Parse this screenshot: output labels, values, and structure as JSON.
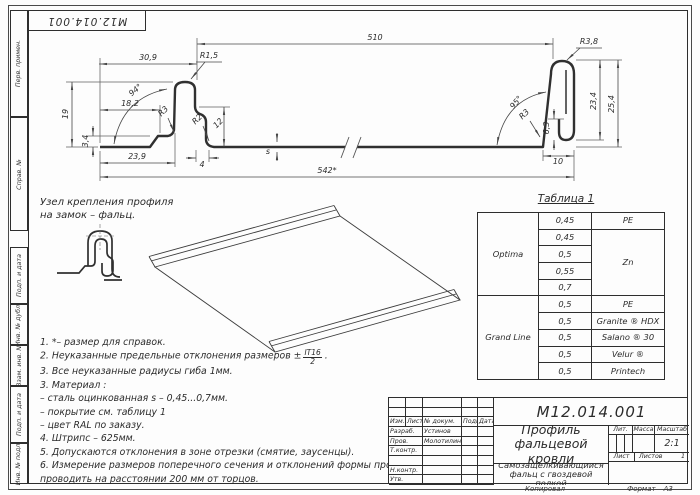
{
  "corner_stamp": {
    "text": "М12.014.001"
  },
  "frame_fields": [
    "Перв. примен.",
    "Справ. №",
    "Подп. и дата",
    "Инв. № дубл.",
    "Взам. инв. №",
    "Подп. и дата",
    "Инв. № подл."
  ],
  "detail_callout": {
    "line1": "Узел крепления профиля",
    "line2": "на замок – фальц."
  },
  "drawing_labels": [
    {
      "t": "30,9",
      "x": 148,
      "y": 60,
      "r": 0
    },
    {
      "t": "510",
      "x": 375,
      "y": 40,
      "r": 0
    },
    {
      "t": "R1,5",
      "x": 209,
      "y": 58,
      "r": 0
    },
    {
      "t": "R3,8",
      "x": 589,
      "y": 44,
      "r": 0
    },
    {
      "t": "94°",
      "x": 137,
      "y": 92,
      "r": -40
    },
    {
      "t": "95°",
      "x": 518,
      "y": 104,
      "r": -50
    },
    {
      "t": "18,2",
      "x": 130,
      "y": 106,
      "r": 0
    },
    {
      "t": "19",
      "x": 68,
      "y": 114,
      "r": -90
    },
    {
      "t": "3,4",
      "x": 88,
      "y": 141,
      "r": -90
    },
    {
      "t": "23,9",
      "x": 137,
      "y": 159,
      "r": 0
    },
    {
      "t": "4",
      "x": 202,
      "y": 167,
      "r": 0
    },
    {
      "t": "12",
      "x": 220,
      "y": 125,
      "r": -45
    },
    {
      "t": "R2",
      "x": 199,
      "y": 121,
      "r": -45
    },
    {
      "t": "R3",
      "x": 165,
      "y": 113,
      "r": -45
    },
    {
      "t": "R3",
      "x": 526,
      "y": 116,
      "r": -45
    },
    {
      "t": "6,3",
      "x": 549,
      "y": 128,
      "r": -90
    },
    {
      "t": "23,4",
      "x": 596,
      "y": 101,
      "r": -90
    },
    {
      "t": "25,4",
      "x": 614,
      "y": 104,
      "r": -90
    },
    {
      "t": "10",
      "x": 558,
      "y": 164,
      "r": 0
    },
    {
      "t": "s",
      "x": 268,
      "y": 154,
      "r": 0
    },
    {
      "t": "542*",
      "x": 327,
      "y": 173,
      "r": 0
    }
  ],
  "table1": {
    "title": "Таблица 1",
    "rows": [
      {
        "brand": "Optima",
        "brand_span": 5,
        "thickness": "0,45",
        "coating": "PE",
        "coating_span": 1
      },
      {
        "thickness": "0,45",
        "coating": "Zn",
        "coating_span": 4
      },
      {
        "thickness": "0,5"
      },
      {
        "thickness": "0,55"
      },
      {
        "thickness": "0,7"
      },
      {
        "brand": "Grand Line",
        "brand_span": 5,
        "thickness": "0,5",
        "coating": "PE",
        "coating_span": 1
      },
      {
        "thickness": "0,5",
        "coating": "Granite ® HDX",
        "coating_span": 1
      },
      {
        "thickness": "0,5",
        "coating": "Salano ® 30",
        "coating_span": 1
      },
      {
        "thickness": "0,5",
        "coating": "Velur ®",
        "coating_span": 1
      },
      {
        "thickness": "0,5",
        "coating": "Printech",
        "coating_span": 1
      }
    ]
  },
  "notes": [
    {
      "num": "1.",
      "text": "*– размер для справок."
    },
    {
      "num": "2.",
      "text": "Неуказанные предельные отклонения размеров ±",
      "frac_top": "IT16",
      "frac_bottom": "2",
      "tail": "."
    },
    {
      "num": "3.",
      "text": "Все неуказанные радиусы гиба 1мм."
    },
    {
      "num": "3.",
      "text": "Материал :"
    },
    {
      "num": "",
      "text": "– сталь оцинкованная s – 0,45...0,7мм."
    },
    {
      "num": "",
      "text": "– покрытие см. таблицу 1"
    },
    {
      "num": "",
      "text": "– цвет RAL по заказу."
    },
    {
      "num": "4.",
      "text": "Штрипс – 625мм."
    },
    {
      "num": "5.",
      "text": "Допускаются отклонения в зоне отрезки (смятие, заусенцы)."
    },
    {
      "num": "6.",
      "text": "Измерение размеров поперечного сечения и отклонений формы профилей проводить на расстоянии 200 мм от торцов."
    }
  ],
  "title_block": {
    "doc_number": "М12.014.001",
    "name": "Профиль фальцевой кровли",
    "subname": "Самозащёлкивающийся фальц с гвоздевой полкой",
    "left_rows": [
      {
        "type": "grid5",
        "cells": [
          "",
          "",
          "",
          "",
          ""
        ]
      },
      {
        "type": "grid5",
        "cells": [
          "",
          "",
          "",
          "",
          ""
        ]
      },
      {
        "type": "grid5",
        "cells": [
          "Изм.",
          "Лист",
          "№ докум.",
          "Подп.",
          "Дата"
        ]
      },
      {
        "type": "grid4",
        "cells": [
          "Разраб.",
          "Устинов",
          "",
          ""
        ]
      },
      {
        "type": "grid4",
        "cells": [
          "Пров.",
          "Молотилин",
          "",
          ""
        ]
      },
      {
        "type": "grid4",
        "cells": [
          "Т.контр.",
          "",
          "",
          ""
        ]
      },
      {
        "type": "grid4",
        "cells": [
          "",
          "",
          "",
          ""
        ]
      },
      {
        "type": "grid4",
        "cells": [
          "Н.контр.",
          "",
          "",
          ""
        ]
      },
      {
        "type": "grid4",
        "cells": [
          "Утв.",
          "",
          "",
          ""
        ]
      }
    ],
    "lit_label": "Лит.",
    "mass_label": "Масса",
    "scale_label": "Масштаб",
    "scale_value": "2:1",
    "sheet_label": "Лист",
    "sheets_label": "Листов",
    "sheets_value": "1"
  },
  "footer": {
    "copied": "Копировал",
    "format_label": "Формат",
    "format_value": "А3"
  }
}
